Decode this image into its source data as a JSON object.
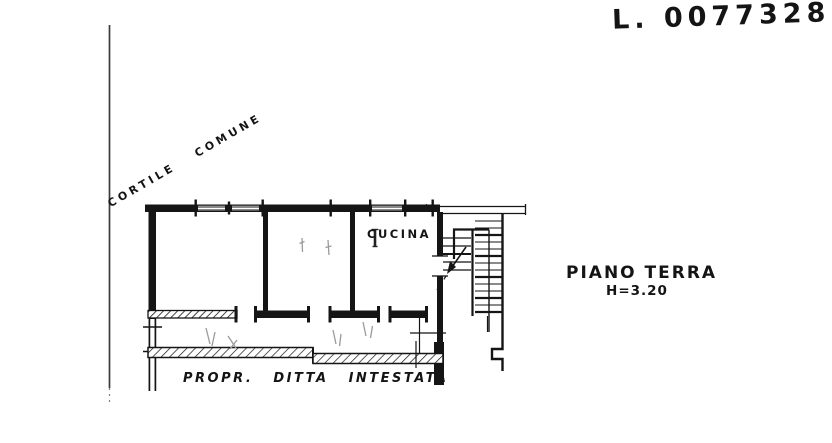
{
  "page": {
    "background": "#ffffff",
    "ink_color": "#151515",
    "pencil_color": "#8f8f8f"
  },
  "annotations": {
    "reference_number": "L. 0077328",
    "courtyard_label": "CORTILE COMUNE",
    "kitchen_label": "CUCINA",
    "floor_label": "PIANO TERRA",
    "floor_height_label": "H=3.20",
    "ownership_label": "PROPR. DITTA INTESTATA"
  }
}
